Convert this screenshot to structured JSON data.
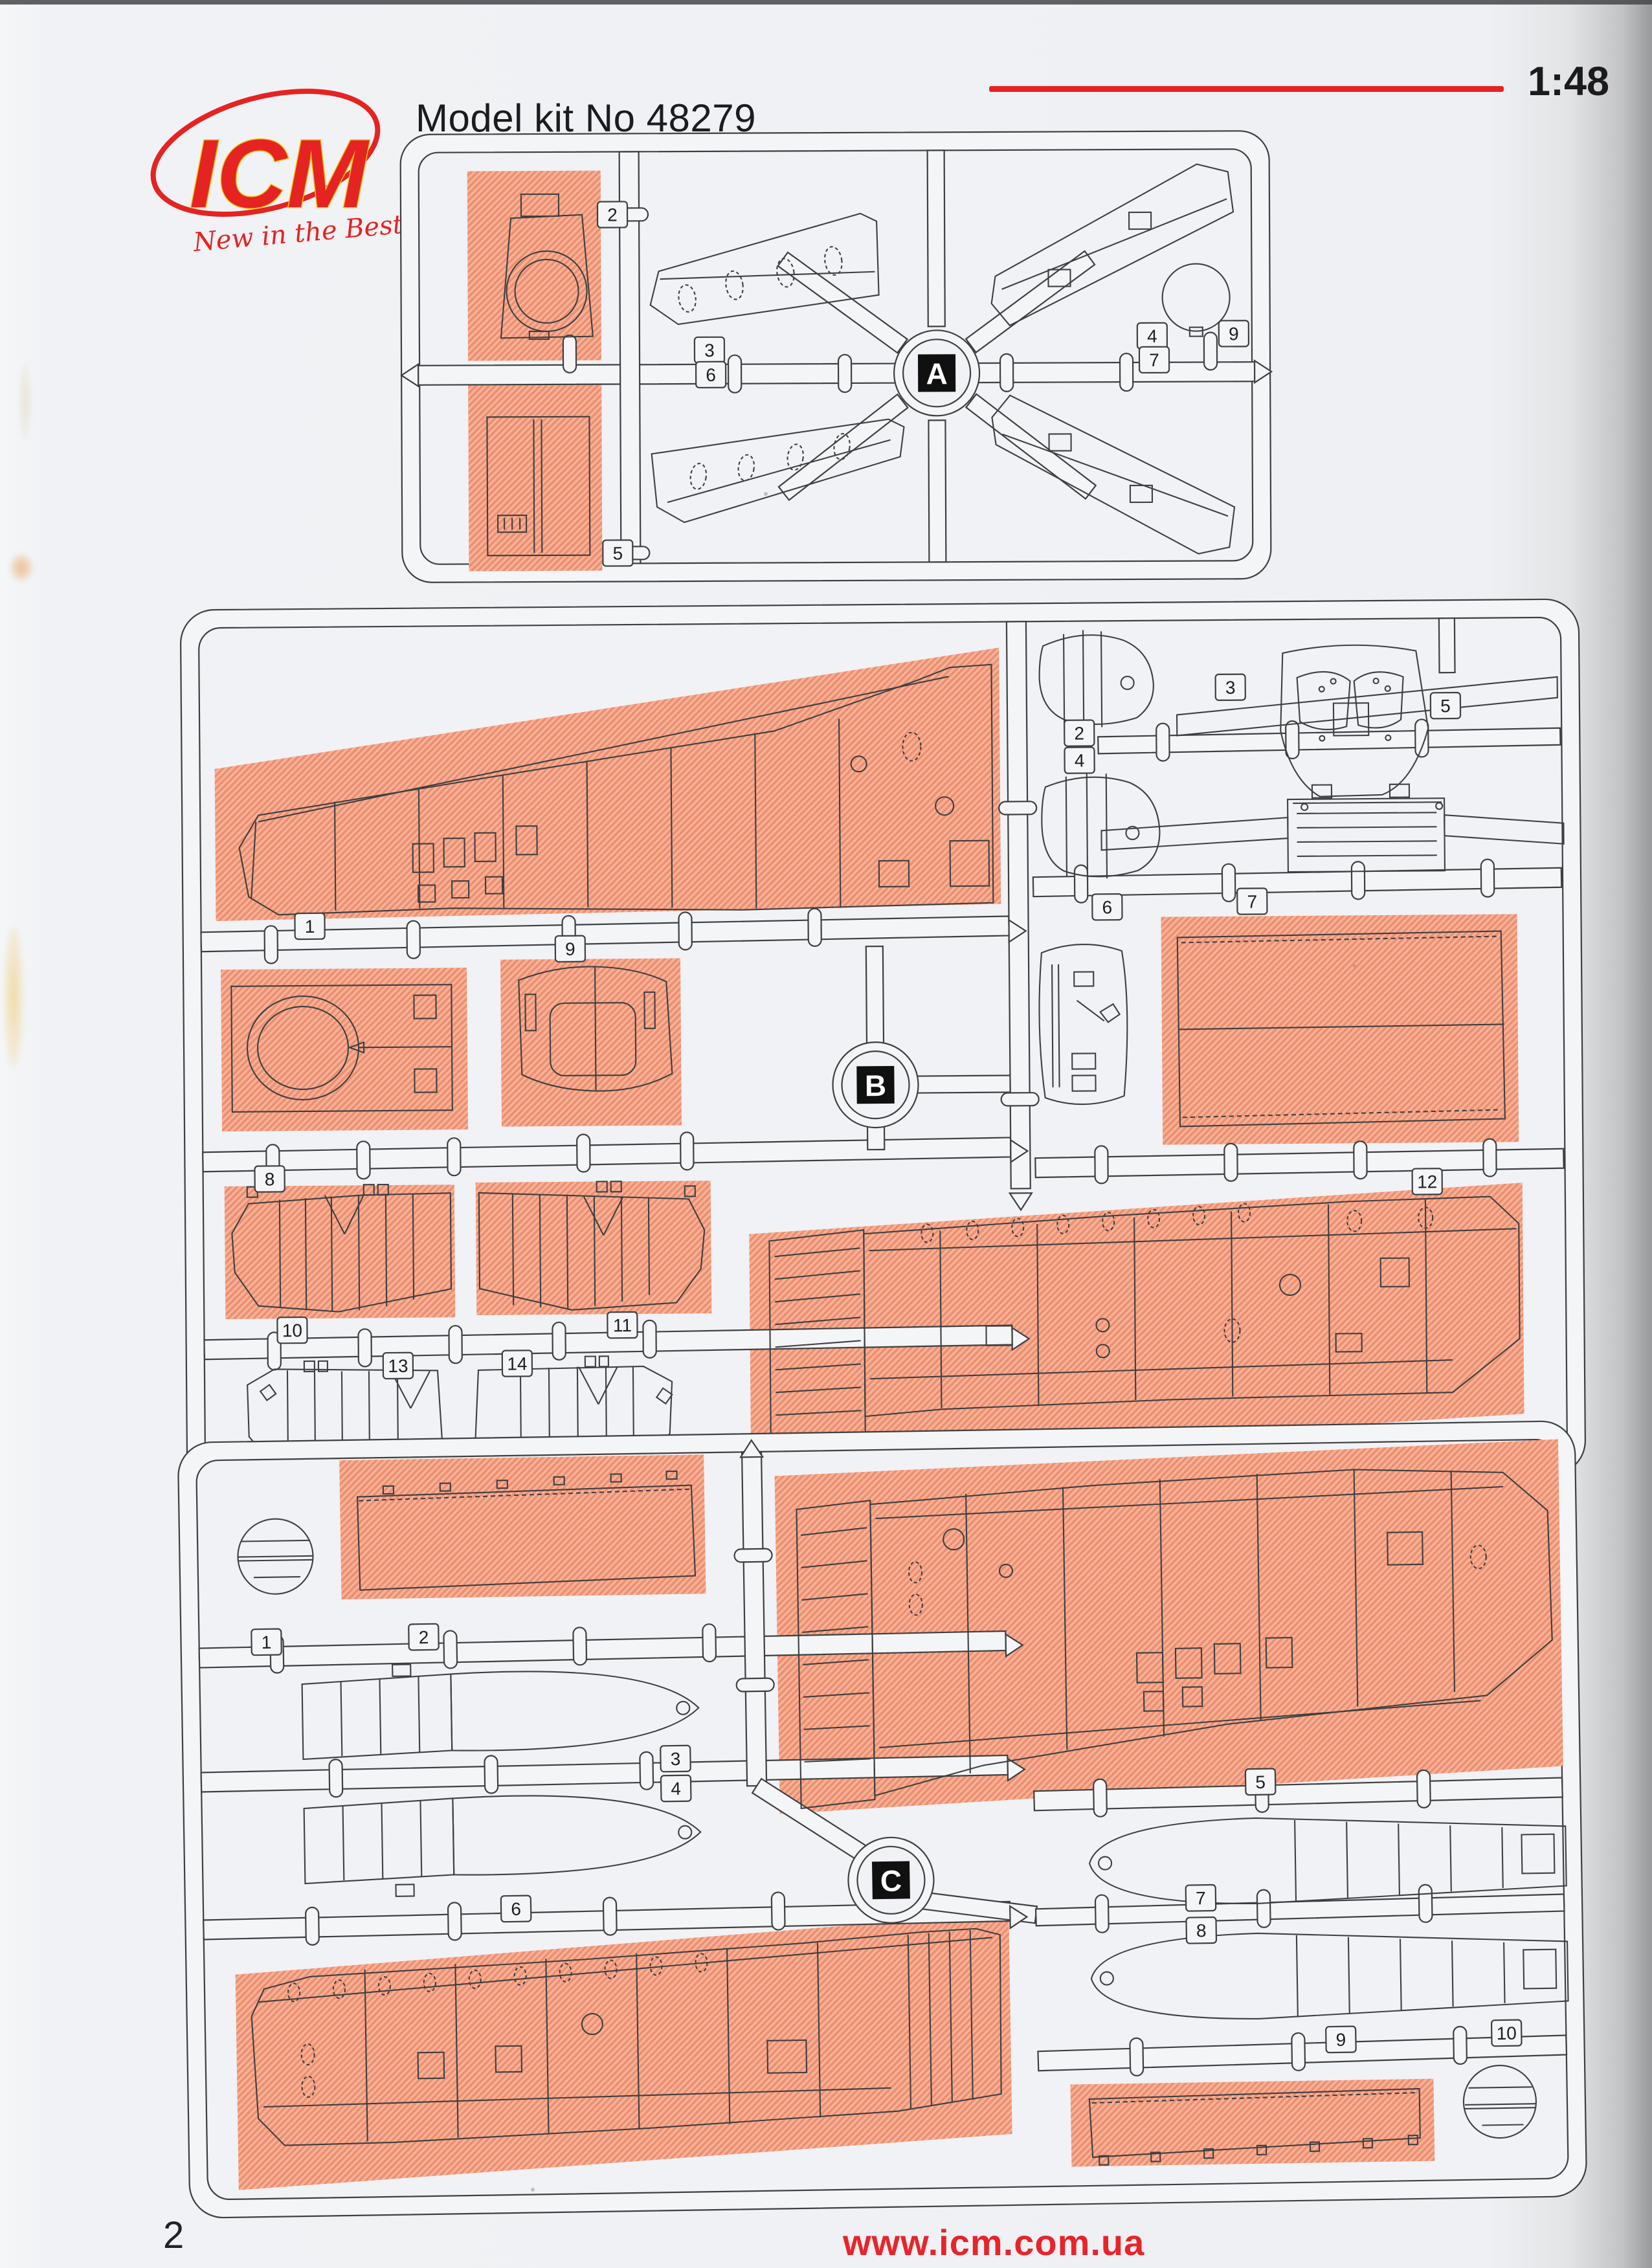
{
  "header": {
    "logo_text": "ICM",
    "logo_tagline": "New in the Best",
    "kit_label": "Model kit No 48279",
    "scale_label": "1:48"
  },
  "footer": {
    "page_number": "2",
    "website": "www.icm.com.ua"
  },
  "colors": {
    "accent_red": "#e52322",
    "salmon_base": "#f6b29a",
    "salmon_stripe": "#ed8e6e",
    "line_art": "#3d3f41",
    "paper": "#eef0f3"
  },
  "sprues": [
    {
      "id": "A",
      "label": "A",
      "parts": [
        {
          "number": "2",
          "highlighted": true
        },
        {
          "number": "3",
          "highlighted": false
        },
        {
          "number": "4",
          "highlighted": false
        },
        {
          "number": "5",
          "highlighted": true
        },
        {
          "number": "6",
          "highlighted": false
        },
        {
          "number": "7",
          "highlighted": false
        },
        {
          "number": "9",
          "highlighted": false
        }
      ]
    },
    {
      "id": "B",
      "label": "B",
      "parts": [
        {
          "number": "1",
          "highlighted": true
        },
        {
          "number": "2",
          "highlighted": false
        },
        {
          "number": "3",
          "highlighted": false
        },
        {
          "number": "4",
          "highlighted": false
        },
        {
          "number": "5",
          "highlighted": false
        },
        {
          "number": "6",
          "highlighted": false
        },
        {
          "number": "7",
          "highlighted": true
        },
        {
          "number": "8",
          "highlighted": true
        },
        {
          "number": "9",
          "highlighted": true
        },
        {
          "number": "10",
          "highlighted": true
        },
        {
          "number": "11",
          "highlighted": true
        },
        {
          "number": "12",
          "highlighted": true
        },
        {
          "number": "13",
          "highlighted": false
        },
        {
          "number": "14",
          "highlighted": false
        }
      ]
    },
    {
      "id": "C",
      "label": "C",
      "parts": [
        {
          "number": "1",
          "highlighted": false
        },
        {
          "number": "2",
          "highlighted": true
        },
        {
          "number": "3",
          "highlighted": false
        },
        {
          "number": "4",
          "highlighted": false
        },
        {
          "number": "5",
          "highlighted": true
        },
        {
          "number": "6",
          "highlighted": true
        },
        {
          "number": "7",
          "highlighted": false
        },
        {
          "number": "8",
          "highlighted": false
        },
        {
          "number": "9",
          "highlighted": true
        },
        {
          "number": "10",
          "highlighted": false
        }
      ]
    }
  ]
}
